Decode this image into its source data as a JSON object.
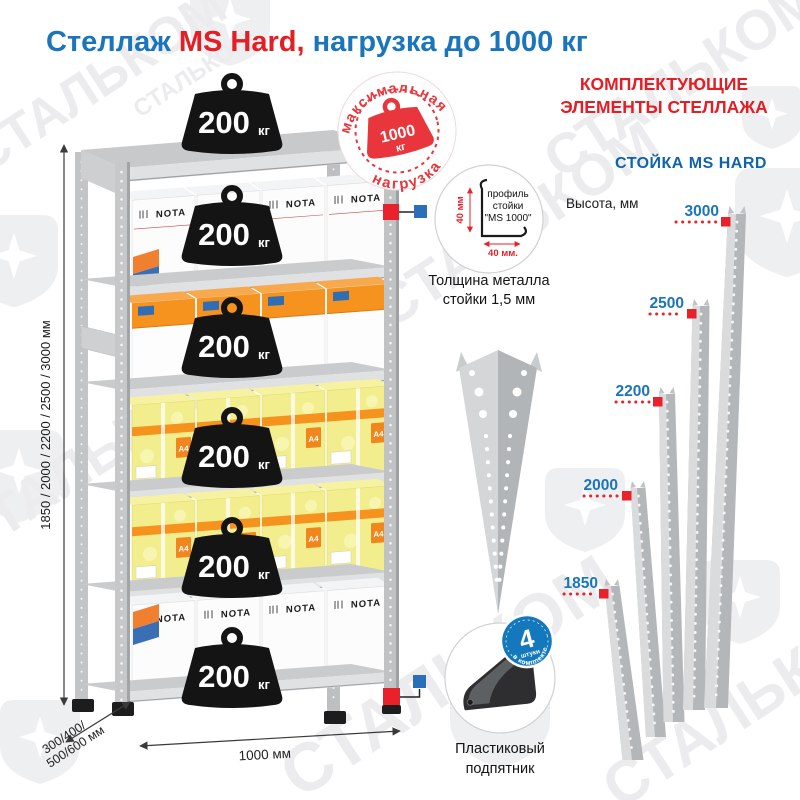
{
  "title": {
    "brand": "Стеллаж ",
    "model": "MS Hard,",
    "rest": " нагрузка до 1000 кг"
  },
  "stamp": {
    "arc_top": "максимальная",
    "arc_bottom": "нагрузка",
    "value": "1000",
    "unit": "кг"
  },
  "rack": {
    "weight": {
      "value": "200",
      "unit": "кг"
    },
    "heights_label": "1850 / 2000 / 2200 / 2500 / 3000 мм",
    "depth_line1": "300/400/",
    "depth_line2": "500/600 мм",
    "width_label": "1000 мм",
    "box_brand": "NOTA",
    "box_size_label": "А4"
  },
  "profile_callout": {
    "line1": "профиль",
    "line2": "стойки",
    "line3": "\"MS 1000\"",
    "dim_vertical": "40 мм",
    "dim_horizontal": "40 мм.",
    "note_line1": "Толщина металла",
    "note_line2": "стойки 1,5 мм"
  },
  "foot_callout": {
    "count": "4",
    "count_unit": "штуки",
    "count_arc": "в комплекте",
    "caption_line1": "Пластиковый",
    "caption_line2": "подпятник"
  },
  "components": {
    "header_line1": "КОМПЛЕКТУЮЩИЕ",
    "header_line2": "ЭЛЕМЕНТЫ СТЕЛЛАЖА",
    "post_title": "СТОЙКА MS HARD",
    "height_caption": "Высота, мм",
    "posts": [
      {
        "h": "3000"
      },
      {
        "h": "2500"
      },
      {
        "h": "2200"
      },
      {
        "h": "2000"
      },
      {
        "h": "1850"
      }
    ]
  },
  "watermark": {
    "text": "СТАЛЬКОМ"
  },
  "colors": {
    "blue": "#1a75bb",
    "red": "#e31e24",
    "badge_blue": "#1478bd",
    "post_gray": "#b4b7ba"
  }
}
